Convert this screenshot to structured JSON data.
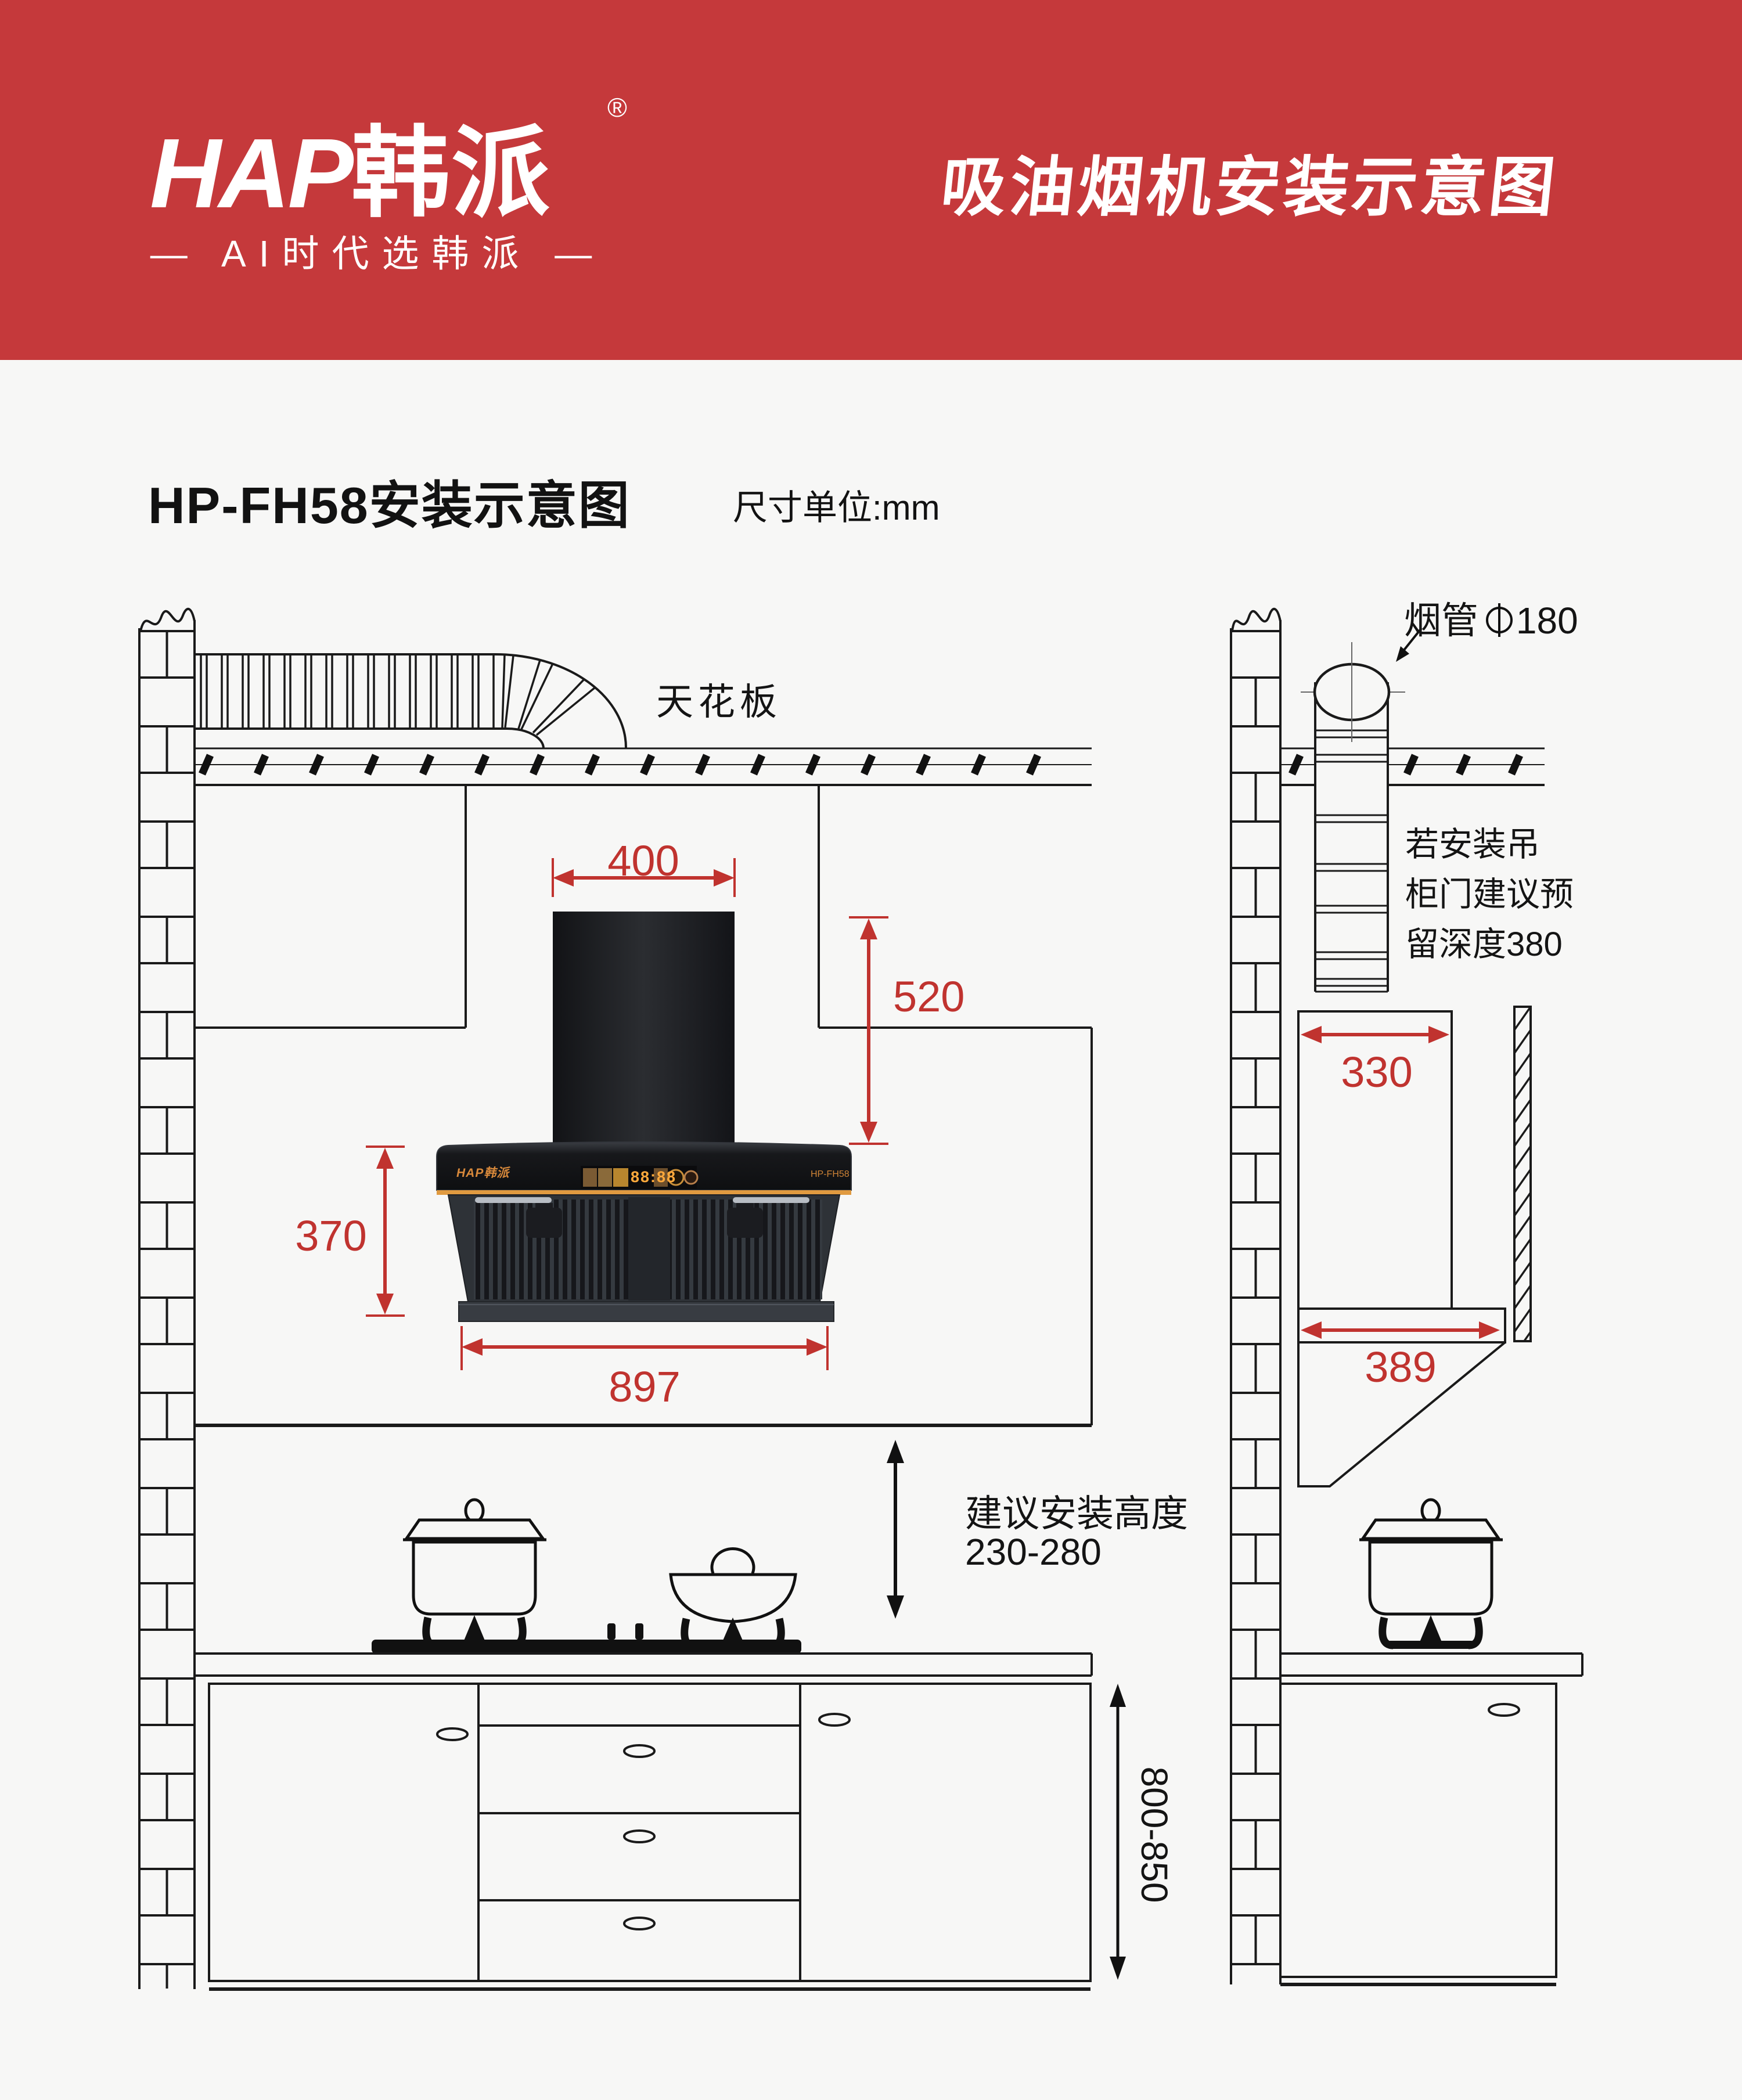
{
  "header": {
    "brand_latin": "HAP",
    "brand_cn": "韩派",
    "registered": "®",
    "tagline": "— AI时代选韩派 —",
    "title": "吸油烟机安装示意图"
  },
  "subtitle": {
    "model_title": "HP-FH58安装示意图",
    "unit_label": "尺寸单位:mm"
  },
  "front_view": {
    "ceiling_label": "天花板",
    "dim_duct_width": "400",
    "dim_niche_height": "520",
    "dim_hood_height": "370",
    "dim_hood_width": "897",
    "install_height_label": "建议安装高度",
    "install_height_value": "230-280",
    "dim_counter_height": "800-850"
  },
  "side_view": {
    "flue_label": "烟管",
    "flue_diameter": "180",
    "note_lines": [
      "若安装吊",
      "柜门建议预",
      "留深度380"
    ],
    "dim_top_depth": "330",
    "dim_bottom_depth": "389"
  },
  "hood": {
    "logo": "HAP韩派",
    "display_time": "88:88",
    "model": "HP-FH58"
  },
  "colors": {
    "header_red": "#C5393B",
    "dim_red": "#C0332F",
    "accent_orange": "#E09A40"
  }
}
